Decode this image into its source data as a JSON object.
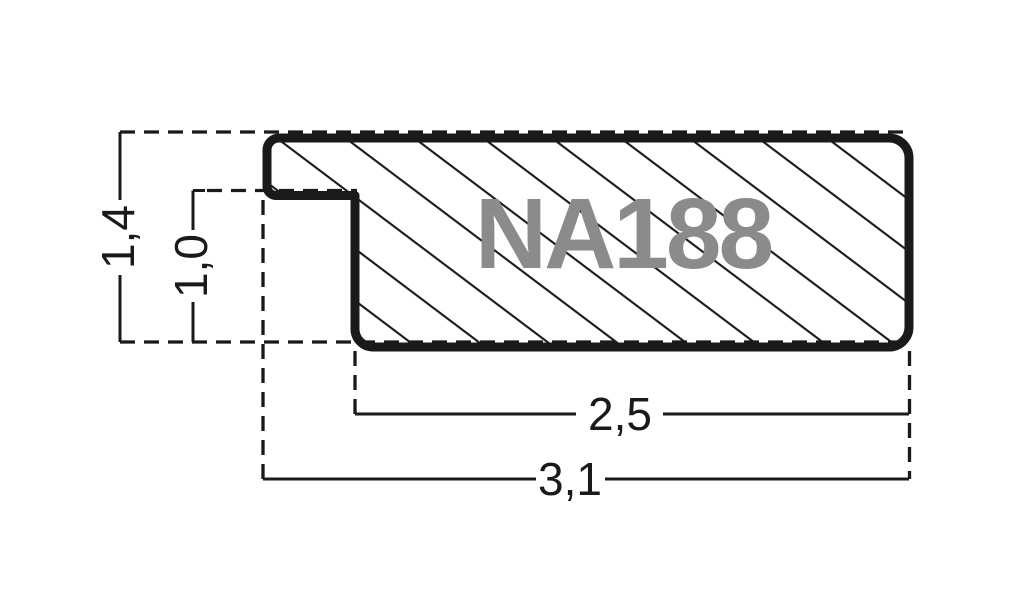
{
  "diagram": {
    "profile_code": "NA188",
    "dimensions": {
      "height_total": "1,4",
      "height_inner": "1,0",
      "width_inner": "2,5",
      "width_total": "3,1"
    }
  },
  "colors": {
    "ink": "#1a1a1a",
    "profile_code_gray": "#8a8b8d",
    "background": "#ffffff"
  }
}
